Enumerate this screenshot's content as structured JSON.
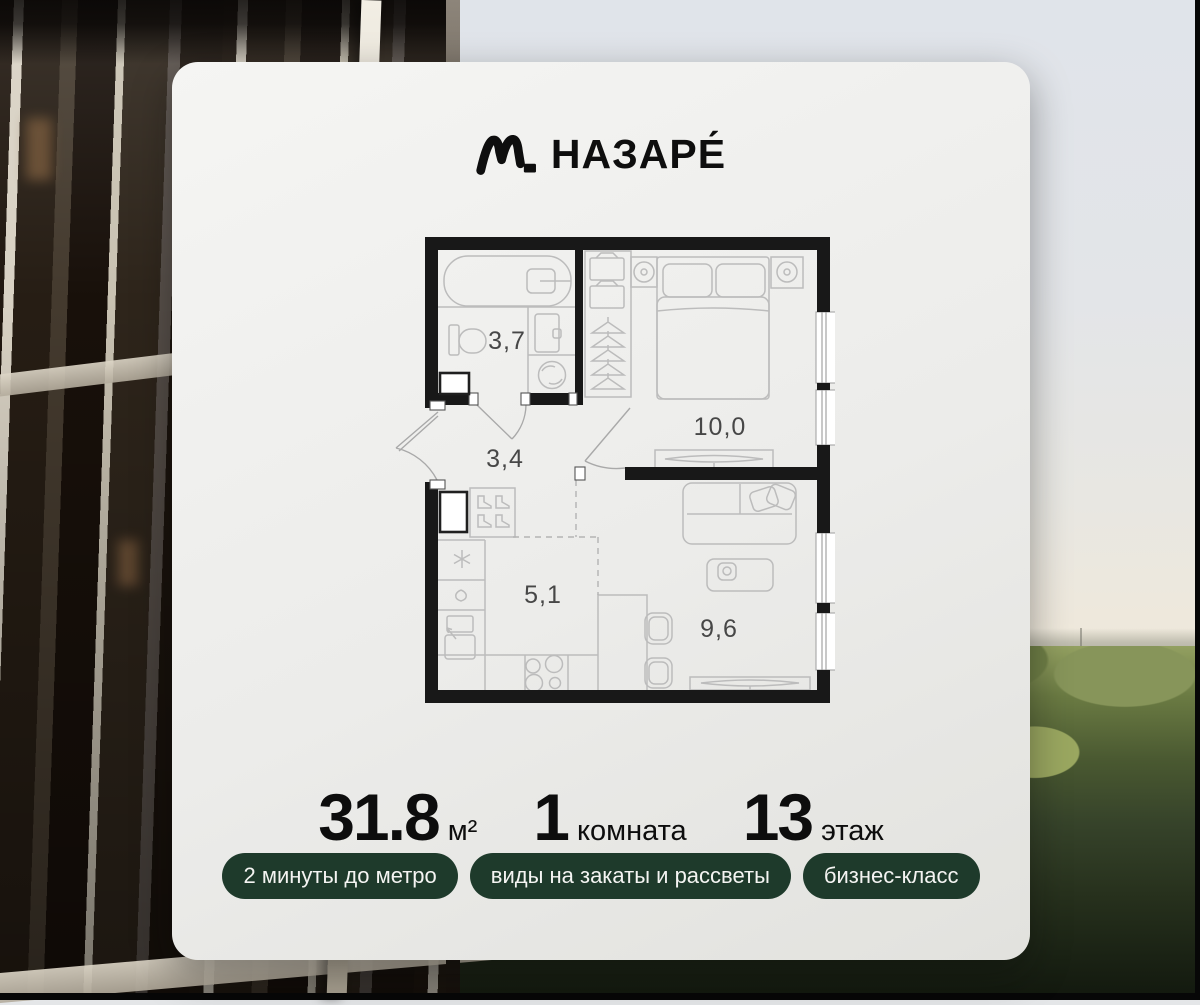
{
  "brand": {
    "name": "НАЗАРЕ́"
  },
  "plan": {
    "rooms": [
      {
        "name": "bathroom",
        "area": "3,7"
      },
      {
        "name": "hallway",
        "area": "3,4"
      },
      {
        "name": "bedroom",
        "area": "10,0"
      },
      {
        "name": "kitchen",
        "area": "5,1"
      },
      {
        "name": "living-room",
        "area": "9,6"
      }
    ]
  },
  "stats": [
    {
      "value": "31.8",
      "unit": "м²"
    },
    {
      "value": "1",
      "unit": "комната"
    },
    {
      "value": "13",
      "unit": "этаж"
    }
  ],
  "badges": [
    "2 минуты до метро",
    "виды на закаты и рассветы",
    "бизнес-класс"
  ],
  "colors": {
    "badge_bg": "#1e3a2b",
    "card_bg": "#ececea",
    "plan_wall": "#181818",
    "text": "#0d0d0d"
  }
}
